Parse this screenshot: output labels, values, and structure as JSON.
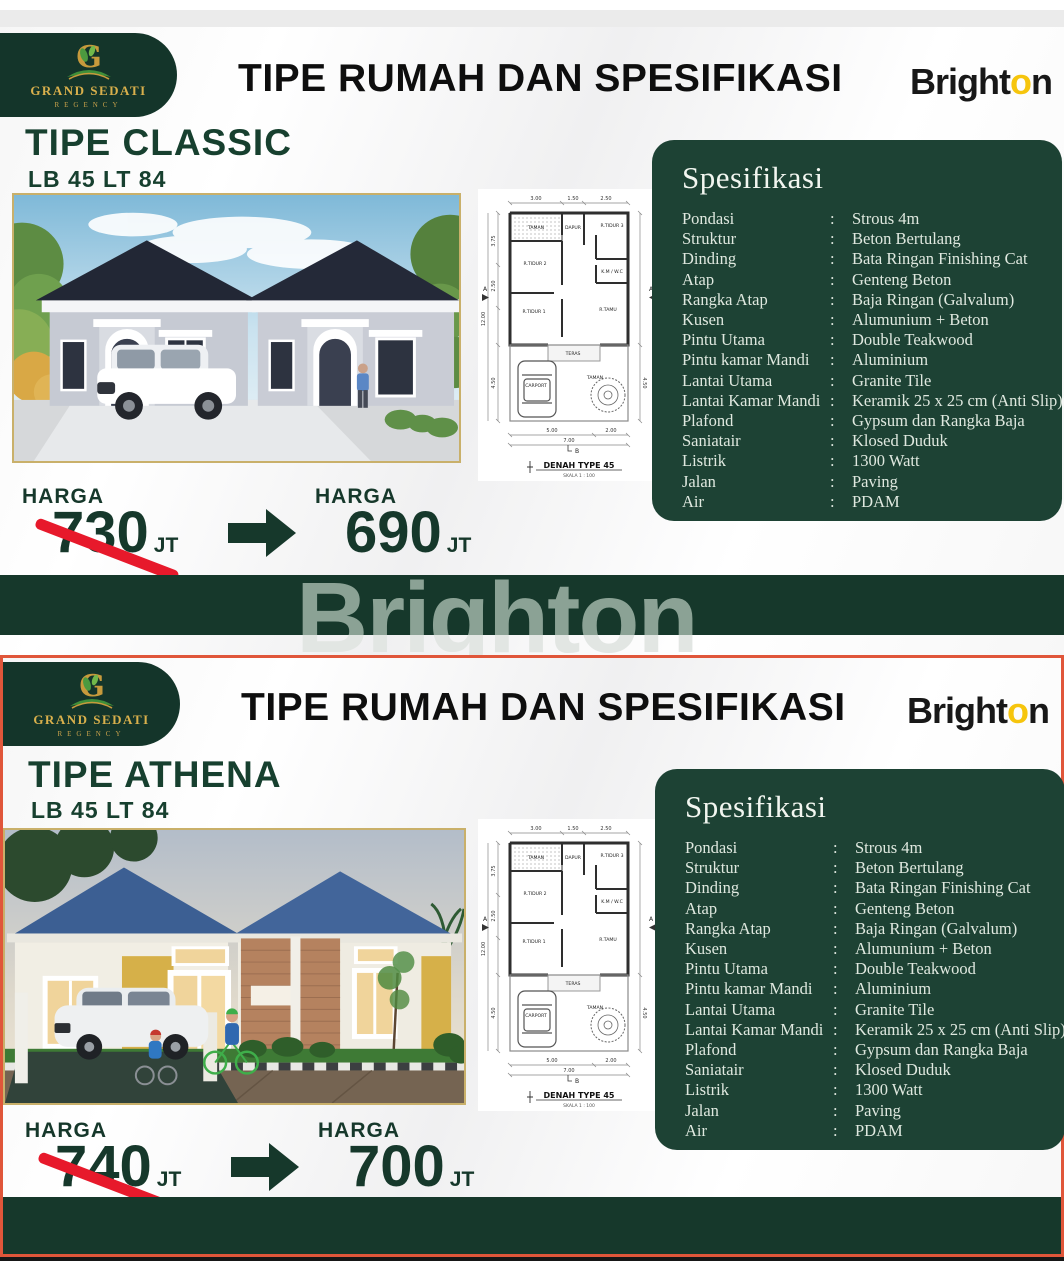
{
  "page": {
    "header_title": "TIPE RUMAH DAN SPESIFIKASI",
    "watermark": "Brighton"
  },
  "logo": {
    "monogram": "G",
    "name": "GRAND SEDATI",
    "subname": "REGENCY"
  },
  "brighton": {
    "left": "Bright",
    "accent": "o",
    "right": "n"
  },
  "spec": {
    "title": "Spesifikasi",
    "items": [
      {
        "label": "Pondasi",
        "colon": ":",
        "value": "Strous 4m"
      },
      {
        "label": "Struktur",
        "colon": ":",
        "value": "Beton Bertulang"
      },
      {
        "label": "Dinding",
        "colon": ":",
        "value": "Bata Ringan Finishing Cat"
      },
      {
        "label": "Atap",
        "colon": ":",
        "value": "Genteng Beton"
      },
      {
        "label": "Rangka Atap",
        "colon": ":",
        "value": "Baja Ringan (Galvalum)"
      },
      {
        "label": "Kusen",
        "colon": ":",
        "value": "Alumunium + Beton"
      },
      {
        "label": "Pintu Utama",
        "colon": ":",
        "value": "Double Teakwood"
      },
      {
        "label": "Pintu kamar Mandi",
        "colon": ":",
        "value": "Aluminium"
      },
      {
        "label": "Lantai Utama",
        "colon": ":",
        "value": "Granite Tile"
      },
      {
        "label": "Lantai Kamar Mandi",
        "colon": ":",
        "value": "Keramik 25 x 25 cm (Anti Slip)"
      },
      {
        "label": "Plafond",
        "colon": ":",
        "value": "Gypsum dan Rangka Baja"
      },
      {
        "label": "Saniatair",
        "colon": ":",
        "value": "Klosed Duduk"
      },
      {
        "label": "Listrik",
        "colon": ":",
        "value": "1300 Watt"
      },
      {
        "label": "Jalan",
        "colon": ":",
        "value": "Paving"
      },
      {
        "label": "Air",
        "colon": ":",
        "value": "PDAM"
      }
    ]
  },
  "panel1": {
    "type_name": "TIPE CLASSIC",
    "size": "LB 45 LT 84",
    "price": {
      "old_label": "HARGA",
      "old_value": "730",
      "old_unit": "JT",
      "new_label": "HARGA",
      "new_value": "690",
      "new_unit": "JT"
    }
  },
  "panel2": {
    "type_name": "TIPE ATHENA",
    "size": "LB 45 LT 84",
    "price": {
      "old_label": "HARGA",
      "old_value": "740",
      "old_unit": "JT",
      "new_label": "HARGA",
      "new_value": "700",
      "new_unit": "JT"
    }
  },
  "floorplan": {
    "caption": "DENAH TYPE 45",
    "scale_note": "SKALA 1 : 100",
    "dim_top": [
      "3.00",
      "1.50",
      "2.50"
    ],
    "dim_left": [
      "3.75",
      "2.50",
      "4.50"
    ],
    "dim_left_total": "12.00",
    "dim_bottom": [
      "5.00",
      "2.00"
    ],
    "dim_bottom_total": "7.00",
    "marker_a": "A",
    "marker_b": "B",
    "rooms": {
      "taman_top": "TAMAN",
      "dapur": "DAPUR",
      "tidur3": "R.TIDUR 3",
      "tidur2": "R.TIDUR 2",
      "kmwc": "K.M / W.C",
      "tidur1": "R.TIDUR 1",
      "tamu": "R.TAMU",
      "teras": "TERAS",
      "carport": "CARPORT",
      "taman_bottom": "TAMAN"
    }
  },
  "colors": {
    "brand_green": "#16382b",
    "spec_green": "#1d4234",
    "gold_border": "#c9b06a",
    "gold_text": "#d9b04c",
    "strike_red": "#e7192b",
    "panel2_border": "#e0563a",
    "brighton_yellow": "#f6c50d"
  }
}
